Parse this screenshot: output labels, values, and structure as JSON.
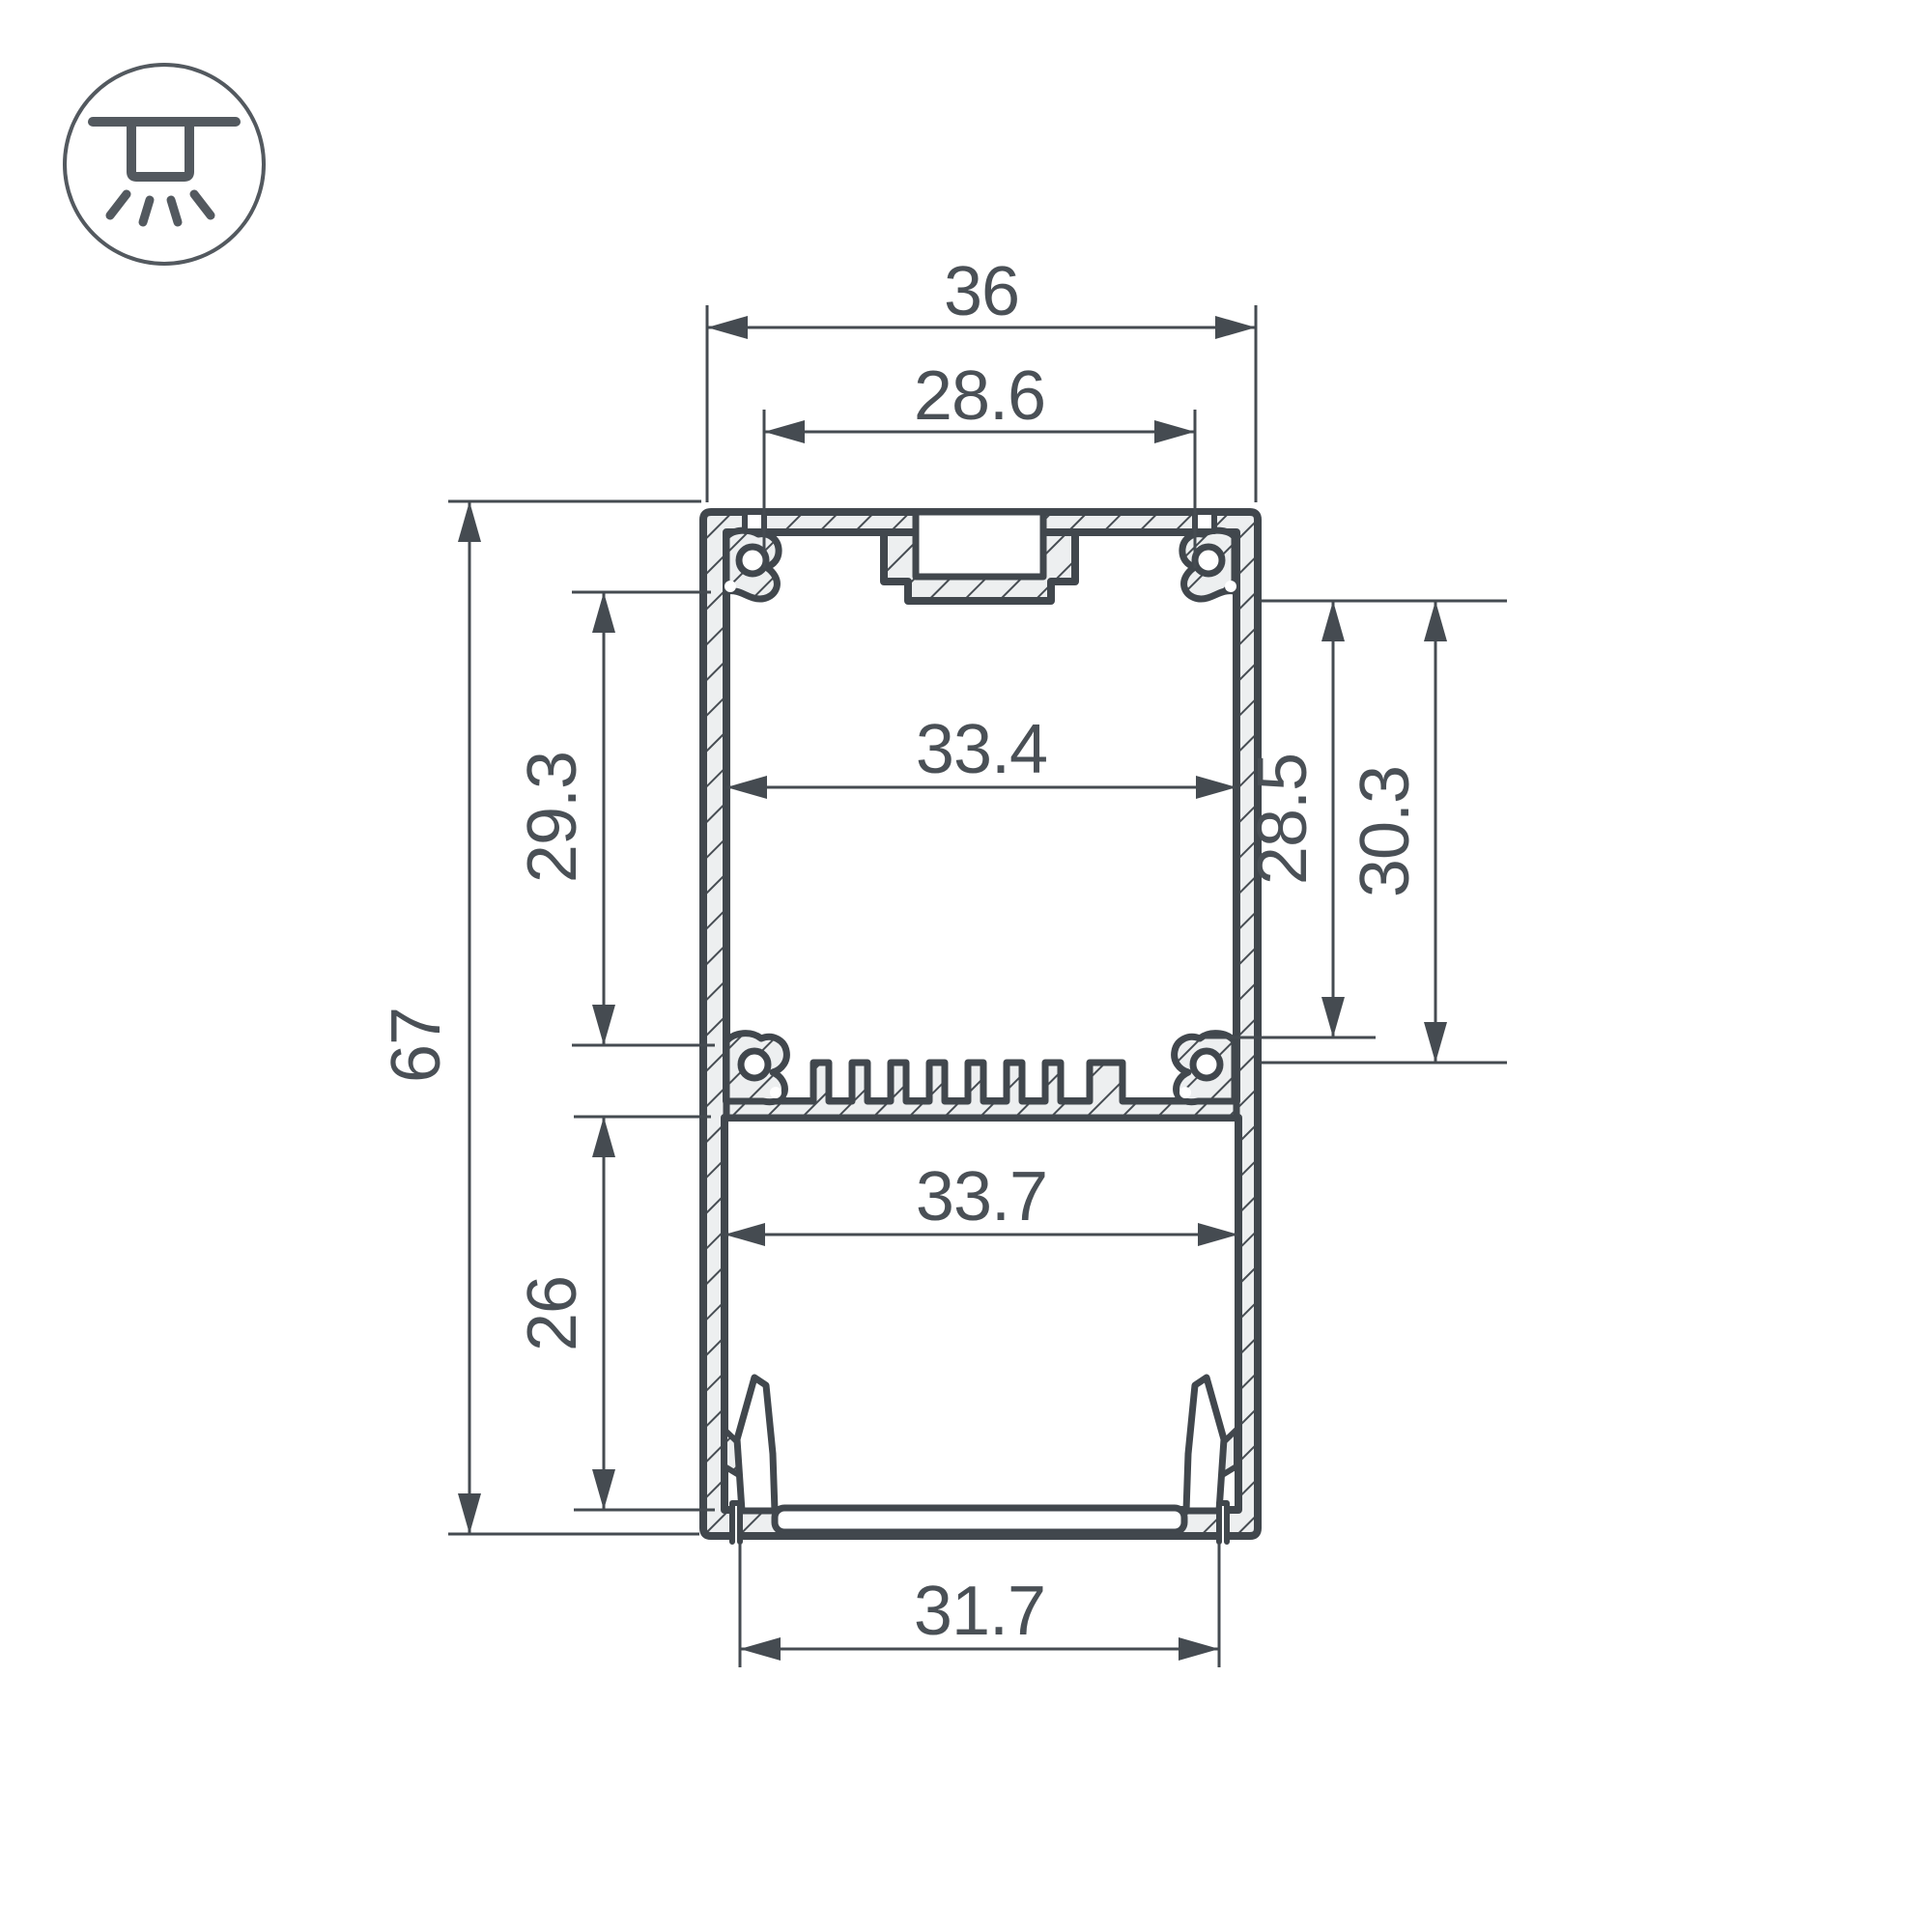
{
  "drawing": {
    "kind": "technical cross-section drawing",
    "subject": "aluminum LED profile"
  },
  "icon": {
    "name": "ceiling-surface-mount-light-icon"
  },
  "colors": {
    "line": "#41474d",
    "dim_line": "#454b51",
    "text": "#4a5056",
    "metal_fill": "#edeff0",
    "background": "#ffffff"
  },
  "dimensions": {
    "overall_width": "36",
    "top_slot_width": "28.6",
    "inner_width_upper": "33.4",
    "upper_inner_height_left": "29.3",
    "overall_height": "67",
    "lower_inner_height_left": "26",
    "inner_width_lower": "33.7",
    "bottom_opening_width": "31.7",
    "right_inner_height_to_boss": "28.5",
    "right_inner_height_to_fins": "30.3"
  }
}
